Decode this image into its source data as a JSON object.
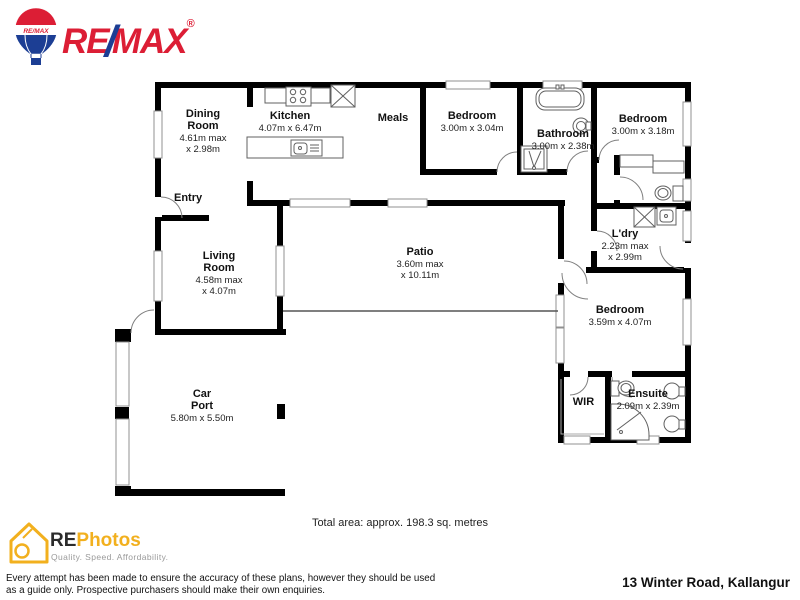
{
  "branding": {
    "remax": {
      "re": "RE",
      "slash": "/",
      "max": "MAX",
      "registered": "®",
      "balloon_text": "RE/MAX",
      "red": "#DC1E35",
      "blue": "#1C3E94"
    },
    "rephotos": {
      "re": "RE",
      "photos": "Photos",
      "tagline": "Quality. Speed. Affordability.",
      "yellow": "#F2B01E"
    }
  },
  "rooms": {
    "dining": {
      "name": "Dining\nRoom",
      "dims": "4.61m max\nx 2.98m"
    },
    "kitchen": {
      "name": "Kitchen",
      "dims": "4.07m x 6.47m"
    },
    "meals": {
      "name": "Meals"
    },
    "bedroom_top_1": {
      "name": "Bedroom",
      "dims": "3.00m x 3.04m"
    },
    "bathroom": {
      "name": "Bathroom",
      "dims": "3.00m x 2.38m"
    },
    "bedroom_top_2": {
      "name": "Bedroom",
      "dims": "3.00m x 3.18m"
    },
    "entry": {
      "name": "Entry"
    },
    "living": {
      "name": "Living\nRoom",
      "dims": "4.58m max\nx 4.07m"
    },
    "patio": {
      "name": "Patio",
      "dims": "3.60m max\nx 10.11m"
    },
    "laundry": {
      "name": "L'dry",
      "dims": "2.23m max\nx 2.99m"
    },
    "bedroom_main": {
      "name": "Bedroom",
      "dims": "3.59m x 4.07m"
    },
    "wir": {
      "name": "WIR"
    },
    "ensuite": {
      "name": "Ensuite",
      "dims": "2.09m x 2.39m"
    },
    "carport": {
      "name": "Car\nPort",
      "dims": "5.80m x 5.50m"
    }
  },
  "footer": {
    "total_area": "Total area: approx. 198.3 sq. metres",
    "disclaimer": "Every attempt has been made to ensure the accuracy of these plans, however they should be used\nas a guide only.  Prospective purchasers should make their own enquiries.",
    "address": "13 Winter Road, Kallangur"
  }
}
